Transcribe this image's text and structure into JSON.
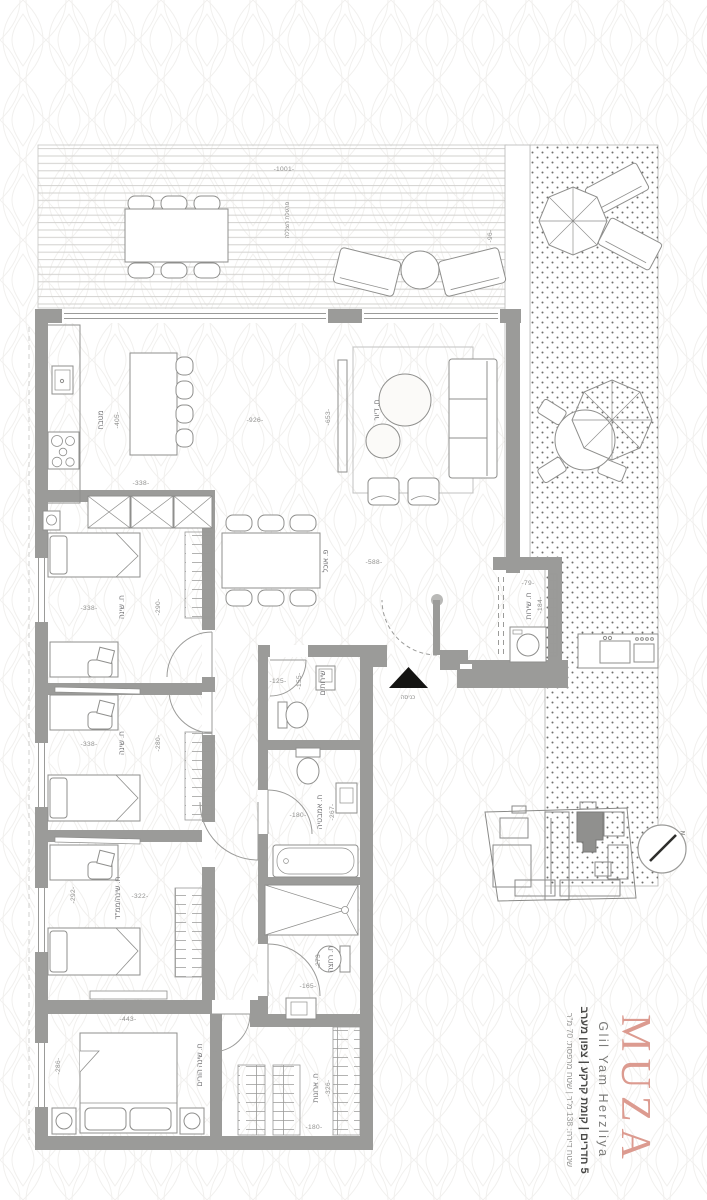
{
  "branding": {
    "logo": "MUZA",
    "location_en": "Glil Yam Herzliya",
    "spec_line": "5 חדרים | קומת קרקע | צפון מערב",
    "area_line": "שטח דירה: 138 מ\"ר | שטח מרפסת: 70 מ\"ר",
    "logo_color": "#dc9b90"
  },
  "plan": {
    "rooms": {
      "kitchen": "מטבח",
      "dining": "פ. אוכל",
      "living": "ח. דיור",
      "bedroom_a": "ח. שינה",
      "bedroom_b": "ח. שינה",
      "bedroom_c": "ח. שינה/ממ\"ד",
      "master": "ח. שינה הורים",
      "closets": "ח. ארונות",
      "service": "ח. שירות",
      "toilet": "שירותים",
      "bathroom": "ח. אמבטיה",
      "shower_room": "ח. רחצה",
      "entrance": "כניסה",
      "pergola": "פרגולת הצללה"
    },
    "dims": {
      "deck_w": "-1001-",
      "deck_d": "-96-",
      "kitchen_w": "-926-",
      "kitchen_island": "-405-",
      "kitchen_d": "-338-",
      "living_d": "-653-",
      "dining_w": "-588-",
      "bedroom_a_w": "-338-",
      "bedroom_a_d": "-290-",
      "bedroom_b_w": "-338-",
      "bedroom_b_d": "-280-",
      "bedroom_c_w": "-322-",
      "bedroom_c_d": "-292-",
      "master_w": "-443-",
      "master_d": "-286-",
      "closets_w": "-326-",
      "closets_d": "-180-",
      "service_w": "-79-",
      "service_d": "-184-",
      "toilet_w": "-125-",
      "toilet_d": "-155-",
      "bathroom_w": "-180-",
      "bathroom_d": "-267-",
      "shower_w": "-165-",
      "shower_d": "-273-"
    },
    "north_label": "N"
  }
}
